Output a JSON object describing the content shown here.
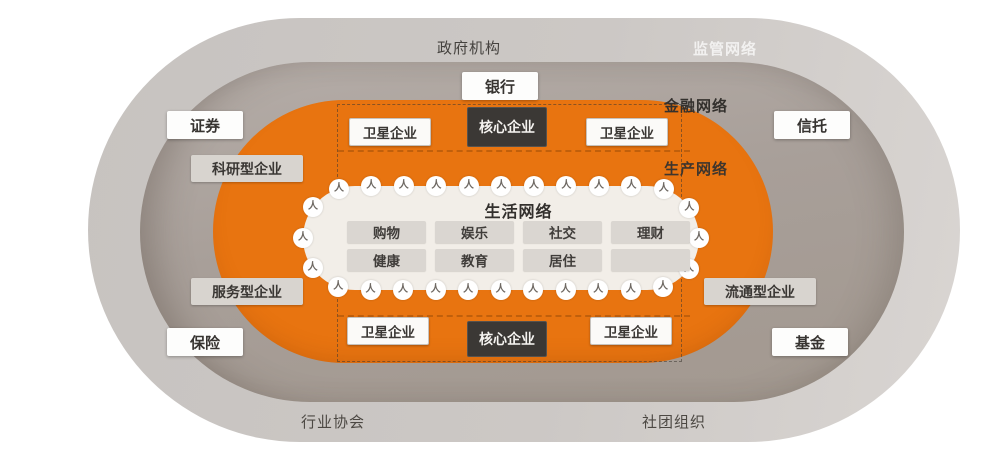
{
  "icons": {
    "person_glyph": "人"
  },
  "colors": {
    "orange_ring": "#e87410",
    "outer_ring": "#ccc8c5",
    "financial_ring": "#a89f99",
    "life_bg": "#f2eee8",
    "core_box_bg": "#3b3835",
    "core_box_text": "#f5f3f0"
  },
  "outer_ring": {
    "top_label": "政府机构",
    "network_label": "监管网络",
    "bottom_left_label": "行业协会",
    "bottom_right_label": "社团组织"
  },
  "financial_ring": {
    "network_label": "金融网络",
    "bank": "银行",
    "securities": "证券",
    "trust": "信托",
    "insurance": "保险",
    "fund": "基金"
  },
  "production_ring": {
    "network_label": "生产网络",
    "core_label": "核心企业",
    "satellite_label": "卫星企业",
    "research_label": "科研型企业",
    "service_label": "服务型企业",
    "circulation_label": "流通型企业"
  },
  "life_network": {
    "title": "生活网络",
    "items": [
      "购物",
      "娱乐",
      "社交",
      "理财",
      "健康",
      "教育",
      "居住",
      ""
    ]
  },
  "decor": {
    "person_count": 28
  }
}
